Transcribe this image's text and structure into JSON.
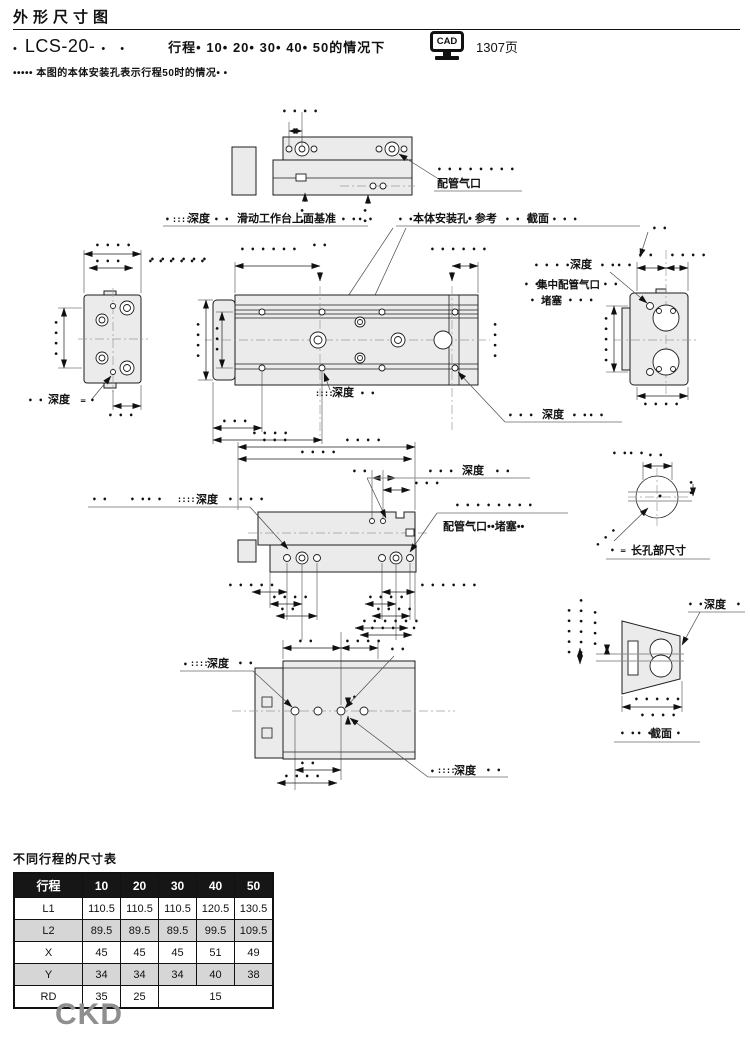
{
  "header": {
    "title": "外形尺寸图",
    "model_bullet": "•",
    "model": "LCS-20-",
    "model_suffix": "• •",
    "stroke_note": "行程• 10• 20• 30• 40• 50的情况下",
    "cad_label": "CAD",
    "cad_page": "1307页",
    "note": "••••• 本图的本体安装孔表示行程50时的情况• •"
  },
  "drawing": {
    "labels": {
      "piping_port": "配管气口",
      "depth": "深度",
      "slide_table_ref": "滑动工作台上面基准",
      "body_mount_ref": "本体安装孔• 参考",
      "section": "截面",
      "central_port": "集中配管气口",
      "plug": "堵塞",
      "port_plug": "配管气口••堵塞••",
      "slot_dim": "长孔部尺寸"
    },
    "masks": {
      "d1": "•",
      "d2": "• •",
      "d3": "• • •",
      "d4": "• • • •",
      "d5": "• • • • •",
      "d6": "• • • • • •",
      "d8": "• • • • • • • •",
      "dm": "• •• •",
      "colon": "::::",
      "eq": "="
    }
  },
  "table": {
    "title": "不同行程的尺寸表",
    "header": [
      "行程",
      "10",
      "20",
      "30",
      "40",
      "50"
    ],
    "rows": [
      {
        "label": "L1",
        "values": [
          "110.5",
          "110.5",
          "110.5",
          "120.5",
          "130.5"
        ]
      },
      {
        "label": "L2",
        "values": [
          "89.5",
          "89.5",
          "89.5",
          "99.5",
          "109.5"
        ]
      },
      {
        "label": "X",
        "values": [
          "45",
          "45",
          "45",
          "51",
          "49"
        ]
      },
      {
        "label": "Y",
        "values": [
          "34",
          "34",
          "34",
          "40",
          "38"
        ]
      },
      {
        "label": "RD",
        "values": [
          "35",
          "25",
          "15"
        ]
      }
    ]
  },
  "footer": {
    "logo": "CKD"
  }
}
